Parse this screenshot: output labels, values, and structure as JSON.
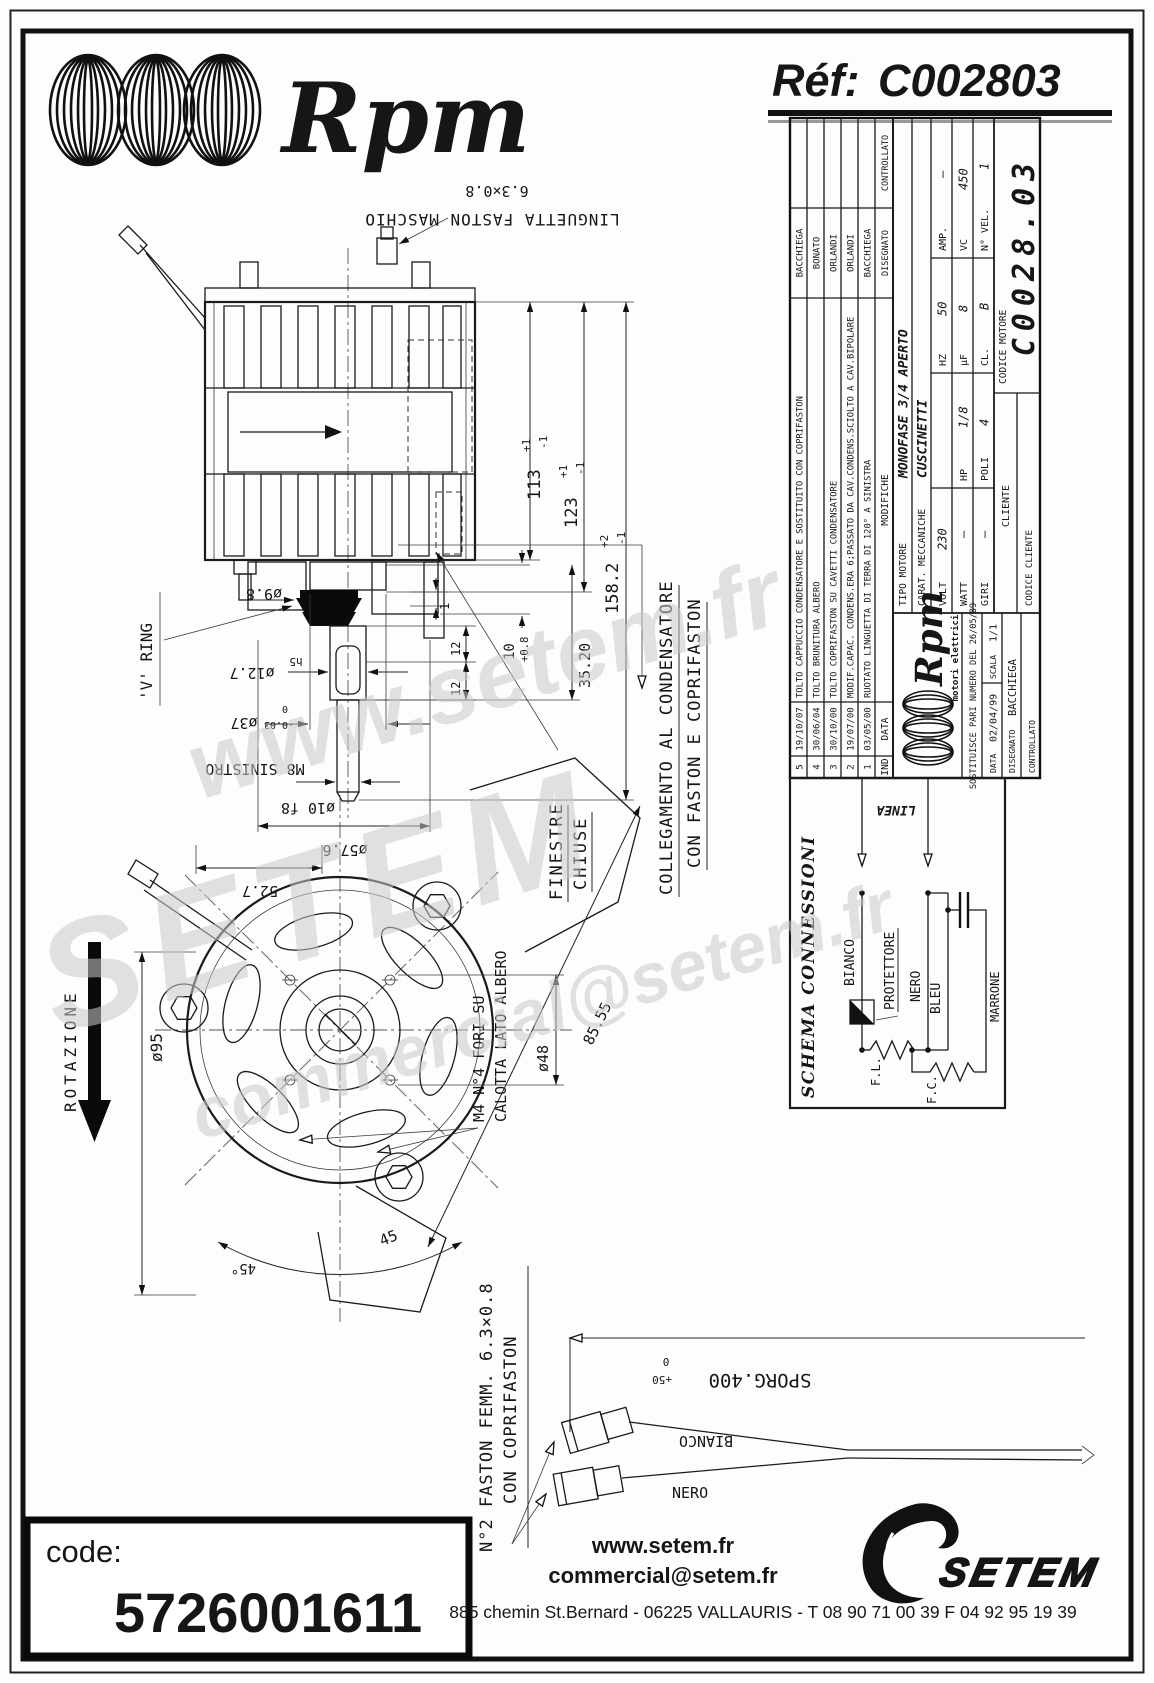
{
  "header": {
    "brand": "Rpm",
    "ref_label": "Réf:",
    "ref_value": "C002803"
  },
  "watermarks": {
    "w1": "www.setem.fr",
    "w2": "SETEM",
    "w3": "commercial@setem.fr"
  },
  "drawing": {
    "faston_size": "6.3×0.8",
    "linguetta": "LINGUETTA FASTON MASCHIO",
    "dim_113": "113",
    "dim_113_tp": "+1",
    "dim_113_tm": "-1",
    "dim_123": "123",
    "dim_123_tp": "+1",
    "dim_123_tm": "-1",
    "dim_158": "158.2",
    "dim_158_tp": "+2",
    "dim_158_tm": "-1",
    "dim_1": "1",
    "dim_12a": "12",
    "dim_12b": "12",
    "dim_10": "10",
    "dim_10_t": "+0.8",
    "dim_3520": "35.20",
    "d98": "ø9.8",
    "d127": "ø12.7",
    "d127_t": "h5",
    "d37": "ø37",
    "d37_t0": "0",
    "d37_tm": "-0.03",
    "m8": "M8 SINISTRO",
    "vring": "'V' RING",
    "d10f8": "ø10 f8",
    "d576": "ø57.6",
    "d527": "52.7",
    "finestre": "FINESTRE",
    "chiuse": "CHIUSE",
    "colleg1": "COLLEGAMENTO AL CONDENSATORE",
    "colleg2": "CON FASTON E COPRIFASTON",
    "rotazione": "ROTAZIONE",
    "d95": "ø95",
    "m4a": "M4 N°4 FORI SU",
    "m4b": "CALOTTA LATO ALBERO",
    "d48": "ø48",
    "d8555": "85.55",
    "a45": "45",
    "a45d": "45°",
    "sporg": "SPORG.400",
    "sporg_tp": "+50",
    "sporg_t0": "0",
    "n2a": "N°2 FASTON FEMM. 6.3×0.8",
    "n2b": "CON COPRIFASTON",
    "bianco": "BIANCO",
    "nero": "NERO"
  },
  "schema": {
    "title": "SCHEMA CONNESSIONI",
    "linea": "LINEA",
    "bianco": "BIANCO",
    "protettore": "PROTETTORE",
    "nero": "NERO",
    "bleu": "BLEU",
    "marrone": "MARRONE",
    "fl": "F.L.",
    "fc": "F.C."
  },
  "titleblock": {
    "revisions": [
      {
        "ind": "5",
        "date": "19/10/07",
        "text": "TOLTO CAPPUCCIO CONDENSATORE E SOSTITUITO CON COPRIFASTON",
        "name": "BACCHIEGA"
      },
      {
        "ind": "4",
        "date": "30/06/04",
        "text": "TOLTO BRUNITURA  ALBERO",
        "name": "BONATO"
      },
      {
        "ind": "3",
        "date": "30/10/00",
        "text": "TOLTO COPRIFASTON SU CAVETTI CONDENSATORE",
        "name": "ORLANDI"
      },
      {
        "ind": "2",
        "date": "19/07/00",
        "text": "MODIF.CAPAC. CONDENS.ERA 6;PASSATO DA CAV.CONDENS.SCIOLTO A CAV.BIPOLARE",
        "name": "ORLANDI"
      },
      {
        "ind": "1",
        "date": "03/05/00",
        "text": "RUOTATO LINGUETTA DI TERRA DI 120° A SINISTRA",
        "name": "BACCHIEGA"
      }
    ],
    "hdr": {
      "ind": "IND",
      "date": "DATA",
      "mod": "MODIFICHE",
      "dis": "DISEGNATO",
      "con": "CONTROLLATO"
    },
    "logo_brand": "Rpm",
    "logo_tag": "motori elettrici",
    "sostituisce": "SOSTITUISCE PARI NUMERO DEL  26/05/89",
    "data_label": "DATA",
    "data_value": "02/04/99",
    "scala_label": "SCALA",
    "scala_value": "1/1",
    "disegnato_label": "DISEGNATO",
    "disegnato_value": "BACCHIEGA",
    "controllato_label": "CONTROLLATO",
    "tipo_label": "TIPO MOTORE",
    "tipo_value": "MONOFASE 3/4 APERTO",
    "carat_label": "CARAT. MECCANICHE",
    "carat_value": "CUSCINETTI",
    "volt_l": "VOLT",
    "volt_v": "230",
    "hz_l": "HZ",
    "hz_v": "50",
    "amp_l": "AMP.",
    "amp_v": "–",
    "watt_l": "WATT",
    "watt_v": "–",
    "hp_l": "HP",
    "hp_v": "1/8",
    "uf_l": "µF",
    "uf_v": "8",
    "vc_l": "VC",
    "vc_v": "450",
    "giri_l": "GIRI",
    "giri_v": "–",
    "poli_l": "POLI",
    "poli_v": "4",
    "cl_l": "CL.",
    "cl_v": "B",
    "nvel_l": "N° VEL.",
    "nvel_v": "1",
    "cliente_label": "CLIENTE",
    "codcli_label": "CODICE CLIENTE",
    "codmot_label": "CODICE MOTORE",
    "codmot_value": "C0028.03"
  },
  "footer": {
    "code_label": "code:",
    "code_value": "5726001611",
    "url": "www.setem.fr",
    "email": "commercial@setem.fr",
    "address": "885 chemin St.Bernard - 06225 VALLAURIS - T 08 90 71 00 39  F 04 92 95 19 39",
    "brand": "SETEM"
  }
}
